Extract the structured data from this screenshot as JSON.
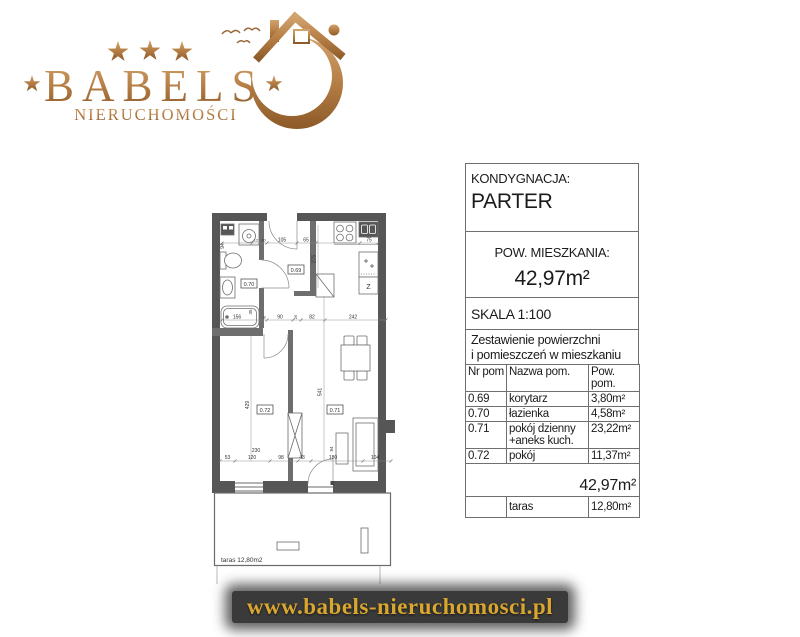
{
  "logo": {
    "brand": "BABELS",
    "subtitle": "NIERUCHOMOŚCI"
  },
  "panel": {
    "floor_label": "KONDYGNACJA:",
    "floor_value": "PARTER",
    "area_label": "POW. MIESZKANIA:",
    "area_value": "42,97m²",
    "scale_label": "SKALA 1:100",
    "table": {
      "title_line1": "Zestawienie powierzchni",
      "title_line2": "i pomieszczeń w mieszkaniu",
      "headers": [
        "Nr pom",
        "Nazwa pom.",
        "Pow. pom."
      ],
      "rows": [
        {
          "nr": "0.69",
          "name": "korytarz",
          "area": "3,80m²"
        },
        {
          "nr": "0.70",
          "name": "łazienka",
          "area": "4,58m²"
        },
        {
          "nr": "0.71",
          "name": "pokój dzienny +aneks kuch.",
          "area": "23,22m²"
        },
        {
          "nr": "0.72",
          "name": "pokój",
          "area": "11,37m²"
        }
      ],
      "total": "42,97m²",
      "extra": {
        "nr": "",
        "name": "taras",
        "area": "12,80m²"
      }
    }
  },
  "plan": {
    "labels": {
      "room_069": "0.69",
      "room_070": "0.70",
      "room_071": "0.71",
      "room_072": "0.72",
      "fridge": "Z",
      "terrace": "taras 12,80m2"
    },
    "dims": {
      "top_12": "12",
      "top_30": "30",
      "top_105": "105",
      "top_65": "65",
      "top_75": "75",
      "left_94": "94",
      "kitchen_275": "275",
      "mid_156": "156",
      "mid_35": "35",
      "mid_8": "8",
      "mid_90": "90",
      "mid_26": "26",
      "mid_82": "82",
      "mid_242": "242",
      "room72_429": "429",
      "room72_230": "230",
      "living_541": "541",
      "sofa_84": "84",
      "bot_53": "53",
      "bot_120": "120",
      "bot_98": "98",
      "bot_43": "43",
      "bot_180": "180",
      "bot_104": "104"
    },
    "colors": {
      "wall": "#565656",
      "innerwall": "#6e6e6e",
      "line": "#808080"
    }
  },
  "footer": {
    "url": "www.babels-nieruchomosci.pl"
  },
  "brand_colors": {
    "gold_light": "#d2a26d",
    "gold_mid": "#b57e45",
    "gold_dark": "#8c5a28"
  }
}
